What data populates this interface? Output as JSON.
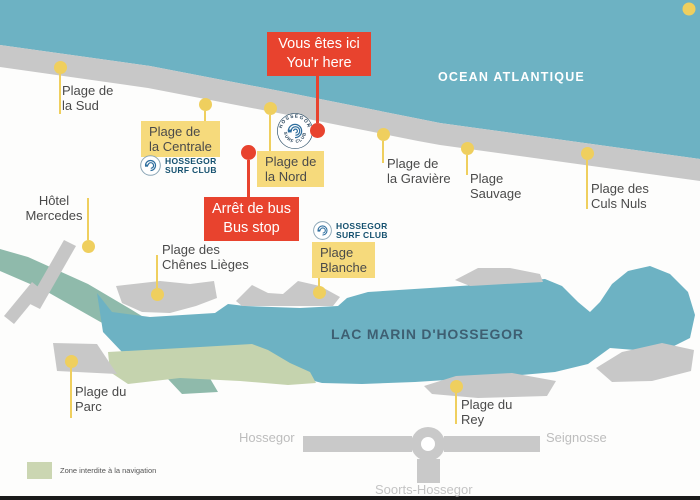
{
  "colors": {
    "ocean": "#6db2c3",
    "sand_gray": "#c8c8c8",
    "canal_green": "#8fbaab",
    "forbidden_zone_green": "#c5d3ae",
    "pin_yellow": "#efcf5e",
    "box_yellow": "#f6da7c",
    "marker_red": "#e8432e",
    "logo_navy": "#15516f",
    "label_text": "#4a4a4a",
    "road_gray": "#c9c9c9"
  },
  "ocean": {
    "label": "OCEAN ATLANTIQUE"
  },
  "lake": {
    "label": "LAC MARIN D'HOSSEGOR"
  },
  "markers": {
    "you_are_here": "Vous êtes ici\nYou'r here",
    "bus_stop": "Arrêt de bus\nBus stop"
  },
  "beaches": {
    "sud": "Plage de\nla Sud",
    "centrale": "Plage de\nla Centrale",
    "nord": "Plage de\nla Nord",
    "graviere": "Plage de\nla Gravière",
    "sauvage": "Plage\nSauvage",
    "culs_nuls": "Plage des\nCuls Nuls",
    "chenes_lieges": "Plage des\nChênes Lièges",
    "blanche": "Plage\nBlanche",
    "parc": "Plage du\nParc",
    "rey": "Plage du\nRey"
  },
  "hotel": {
    "label": "Hôtel\nMercedes"
  },
  "surf_club": {
    "badge_top": "HOSSEGOR",
    "badge_bottom": "SURF CLUB",
    "name": "HOSSEGOR\nSURF CLUB"
  },
  "roads": {
    "west": "Hossegor",
    "east": "Seignosse",
    "south": "Soorts-Hossegor"
  },
  "legend": {
    "zone_label": "Zone interdite à la navigation"
  }
}
